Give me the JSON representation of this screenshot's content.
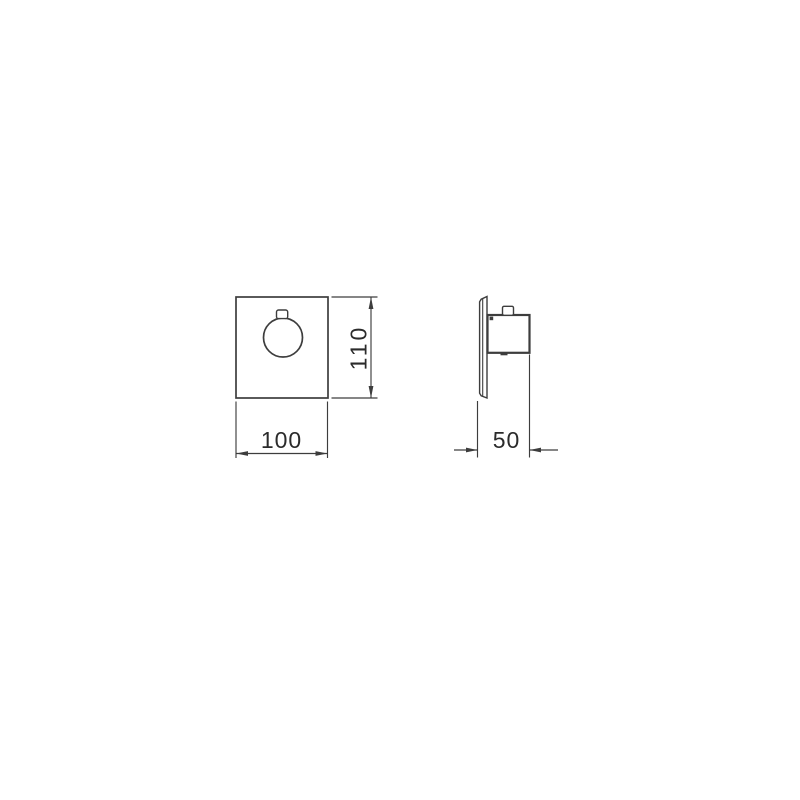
{
  "theme": {
    "background": "#ffffff",
    "line_color": "#3d3d3d",
    "text_color": "#2b2b2b"
  },
  "drawing": {
    "dimensions": {
      "width": {
        "label": "100"
      },
      "height": {
        "label": "110"
      },
      "depth": {
        "label": "50"
      }
    }
  }
}
